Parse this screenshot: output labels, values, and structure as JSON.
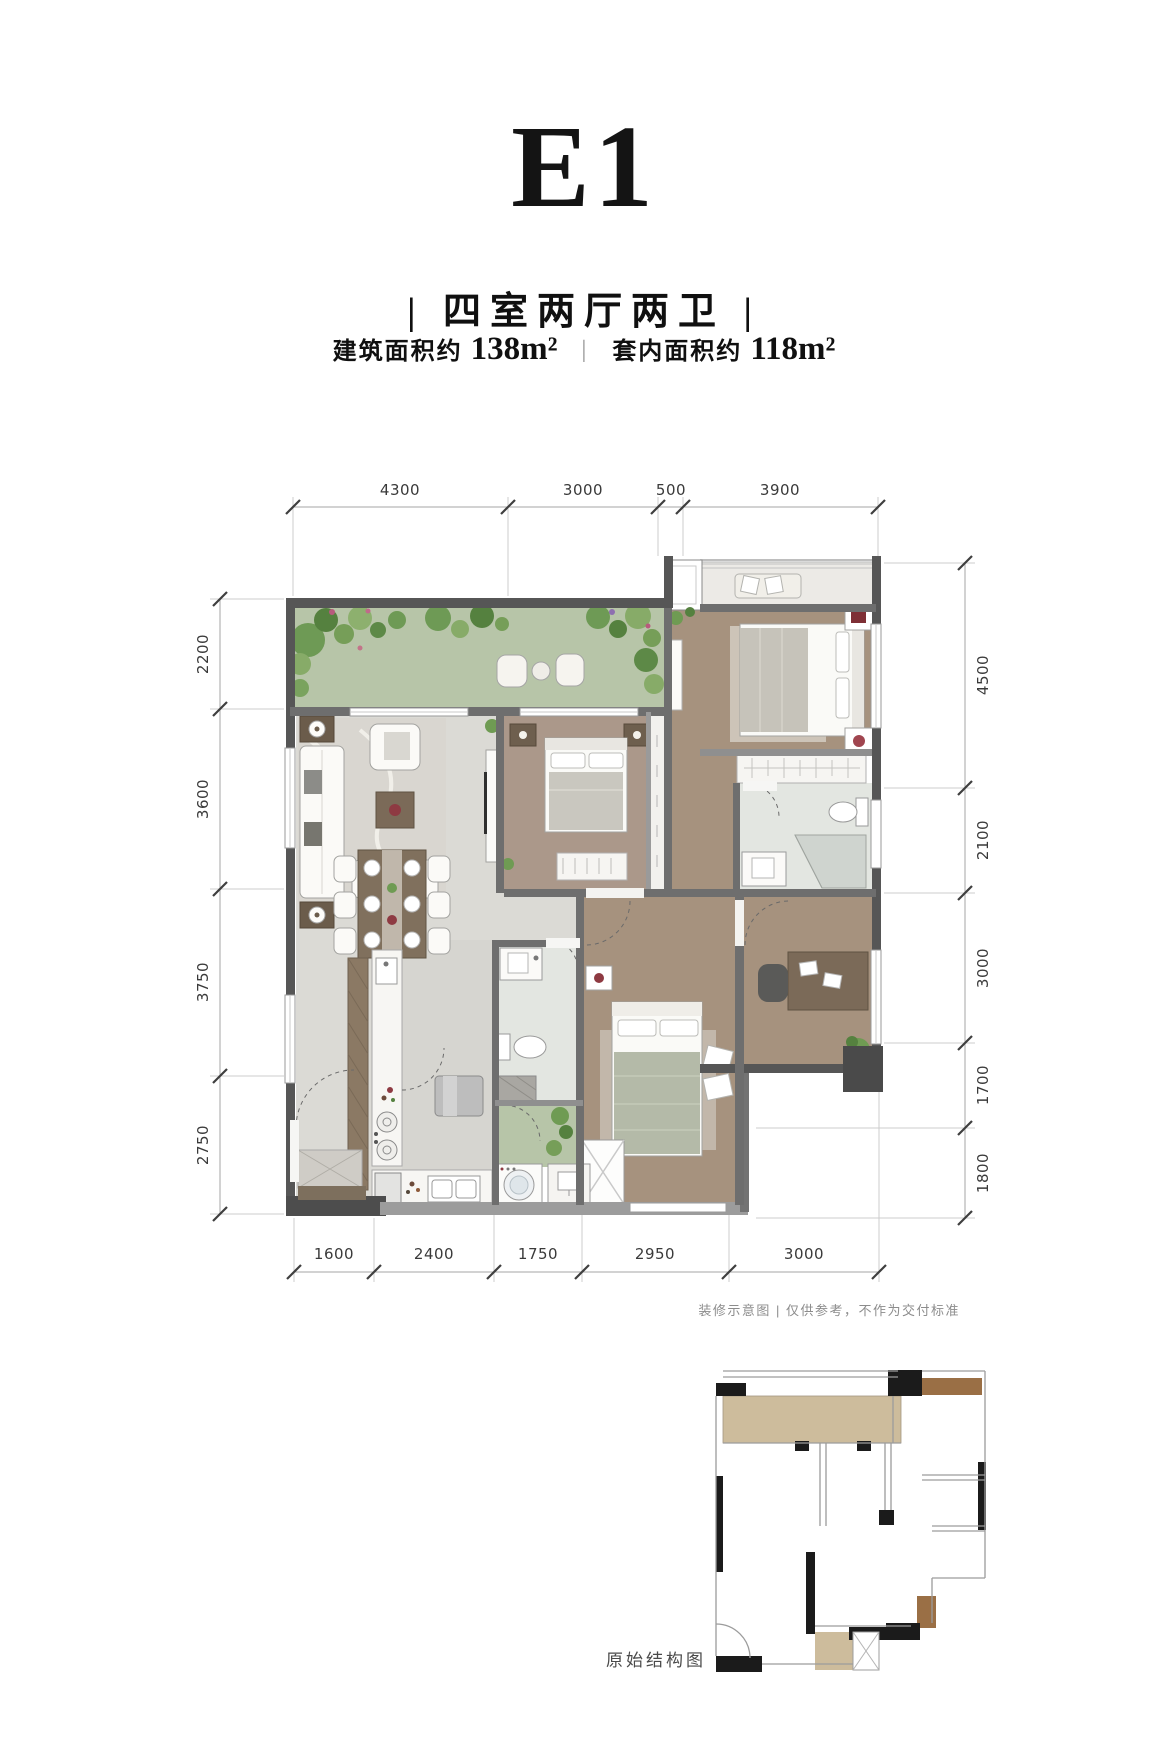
{
  "header": {
    "title": "E1",
    "subtitle": "| 四室两厅两卫 |",
    "area": {
      "build_label": "建筑面积约",
      "build_value": "138m²",
      "separator": "|",
      "inner_label": "套内面积约",
      "inner_value": "118m²"
    }
  },
  "floor_plan": {
    "dimensions_mm": {
      "top": [
        "4300",
        "3000",
        "500",
        "3900"
      ],
      "left": [
        "2200",
        "3600",
        "3750",
        "2750"
      ],
      "right": [
        "4500",
        "2100",
        "3000",
        "1700",
        "1800"
      ],
      "bottom": [
        "1600",
        "2400",
        "1750",
        "2950",
        "3000"
      ]
    }
  },
  "footnotes": {
    "disclaimer": "装修示意图 | 仅供参考，不作为交付标准",
    "structural_plan_label": "原始结构图"
  },
  "colors": {
    "terrace_green": "#b7c5a8",
    "wood_floor": "#a6927e",
    "marble_floor": "#dbdad5",
    "bath_floor": "#e3e6e1",
    "wall_dark": "#565656",
    "accent_red": "#7e2f35",
    "plan_tan": "#cdbc9c",
    "plan_brown": "#9a6f45"
  }
}
